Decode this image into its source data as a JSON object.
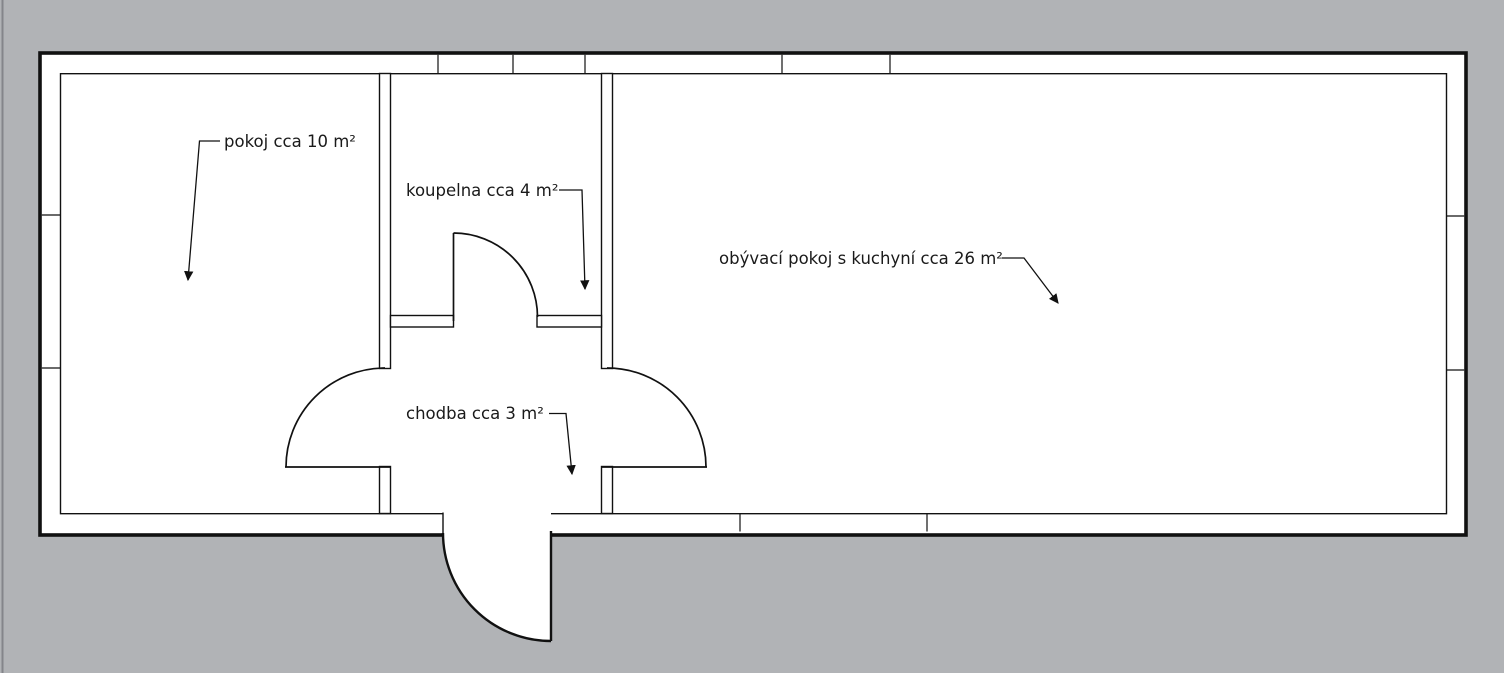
{
  "title": "Floor plan with room areas",
  "rooms": [
    {
      "name": "pokoj",
      "area_m2": 10,
      "label": "pokoj cca 10 m²"
    },
    {
      "name": "koupelna",
      "area_m2": 4,
      "label": "koupelna cca 4 m²"
    },
    {
      "name": "obyvaci-pokoj-s-kuchyni",
      "area_m2": 26,
      "label": "obývací pokoj s kuchyní cca 26 m²"
    },
    {
      "name": "chodba",
      "area_m2": 3,
      "label": "chodba cca 3 m²"
    }
  ],
  "colors": {
    "background": "#b1b3b6",
    "plan_fill": "#ffffff",
    "line": "#111111",
    "text": "#1a1a1a",
    "page_edge": "#84858a"
  }
}
